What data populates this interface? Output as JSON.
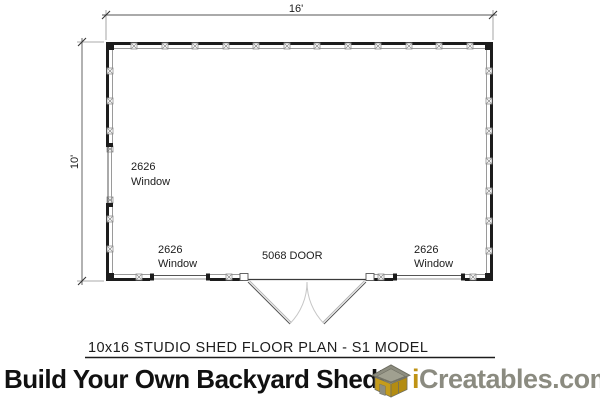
{
  "plan": {
    "title": "10x16 STUDIO SHED FLOOR PLAN - S1 MODEL",
    "dimensions": {
      "width_label": "16'",
      "height_label": "10'"
    },
    "labels": {
      "left_wall_window": {
        "size": "2626",
        "type": "Window"
      },
      "bottom_left_window": {
        "size": "2626",
        "type": "Window"
      },
      "bottom_right_window": {
        "size": "2626",
        "type": "Window"
      },
      "door": "5068 DOOR"
    }
  },
  "banner": {
    "slogan": "Build Your Own Backyard Shed!",
    "brand": {
      "prefix": "i",
      "rest": "Creatables.com"
    }
  },
  "icons": {
    "logo": "shed-3d-icon"
  },
  "colors": {
    "wall_black": "#1c1c1c",
    "inner_line_gray": "#9a9a9a",
    "swing_arc_gray": "#c6c6c6",
    "brand_gold": "#bf9315",
    "brand_gray": "#8b8b80",
    "logo_roof_gray": "#8d8d7f",
    "logo_wall_gold": "#c59c1b"
  }
}
